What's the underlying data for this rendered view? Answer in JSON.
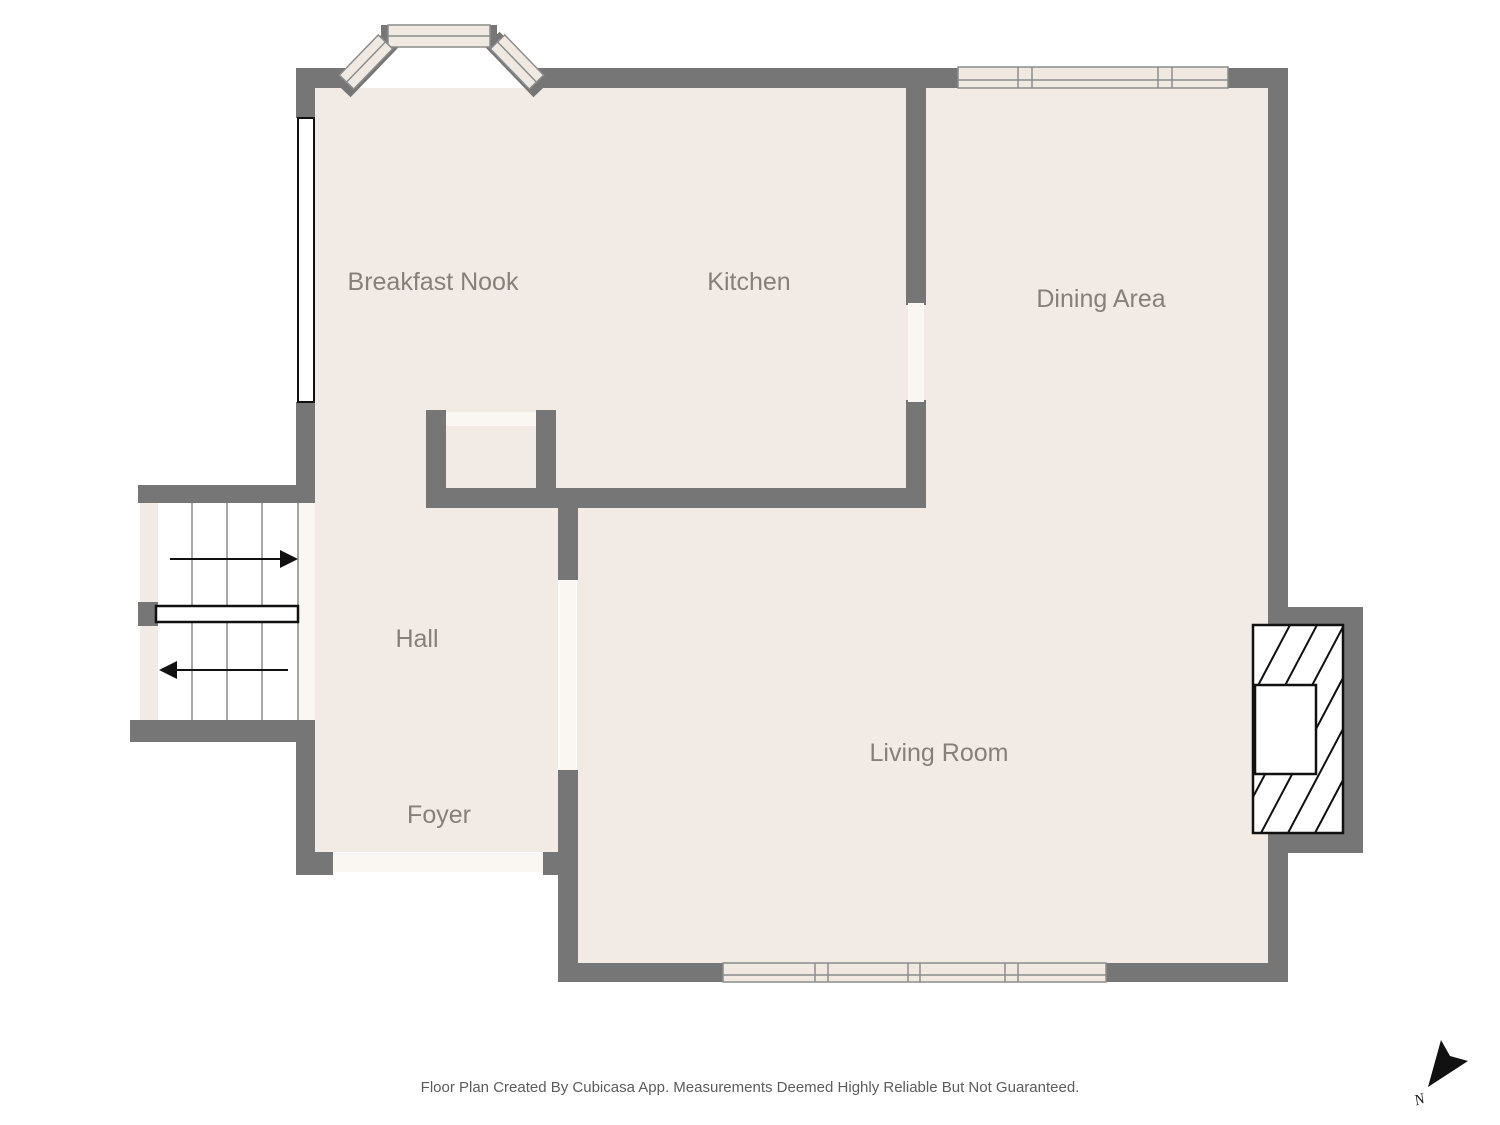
{
  "floor_plan": {
    "rooms": [
      {
        "name": "Breakfast Nook"
      },
      {
        "name": "Kitchen"
      },
      {
        "name": "Dining Area"
      },
      {
        "name": "Hall"
      },
      {
        "name": "Foyer"
      },
      {
        "name": "Living Room"
      }
    ],
    "compass": {
      "label": "N"
    },
    "footer": {
      "disclaimer": "Floor Plan Created By Cubicasa App. Measurements Deemed Highly Reliable But Not Guaranteed."
    },
    "colors": {
      "wall": "#767676",
      "floor": "#f2ebe5",
      "opening": "#faf6f1",
      "window_fill": "#f0e9e2",
      "window_stroke": "#8c8c8c",
      "feature_outline": "#111111",
      "room_label_text": "#868079",
      "footer_text": "#5c5c5c"
    }
  }
}
